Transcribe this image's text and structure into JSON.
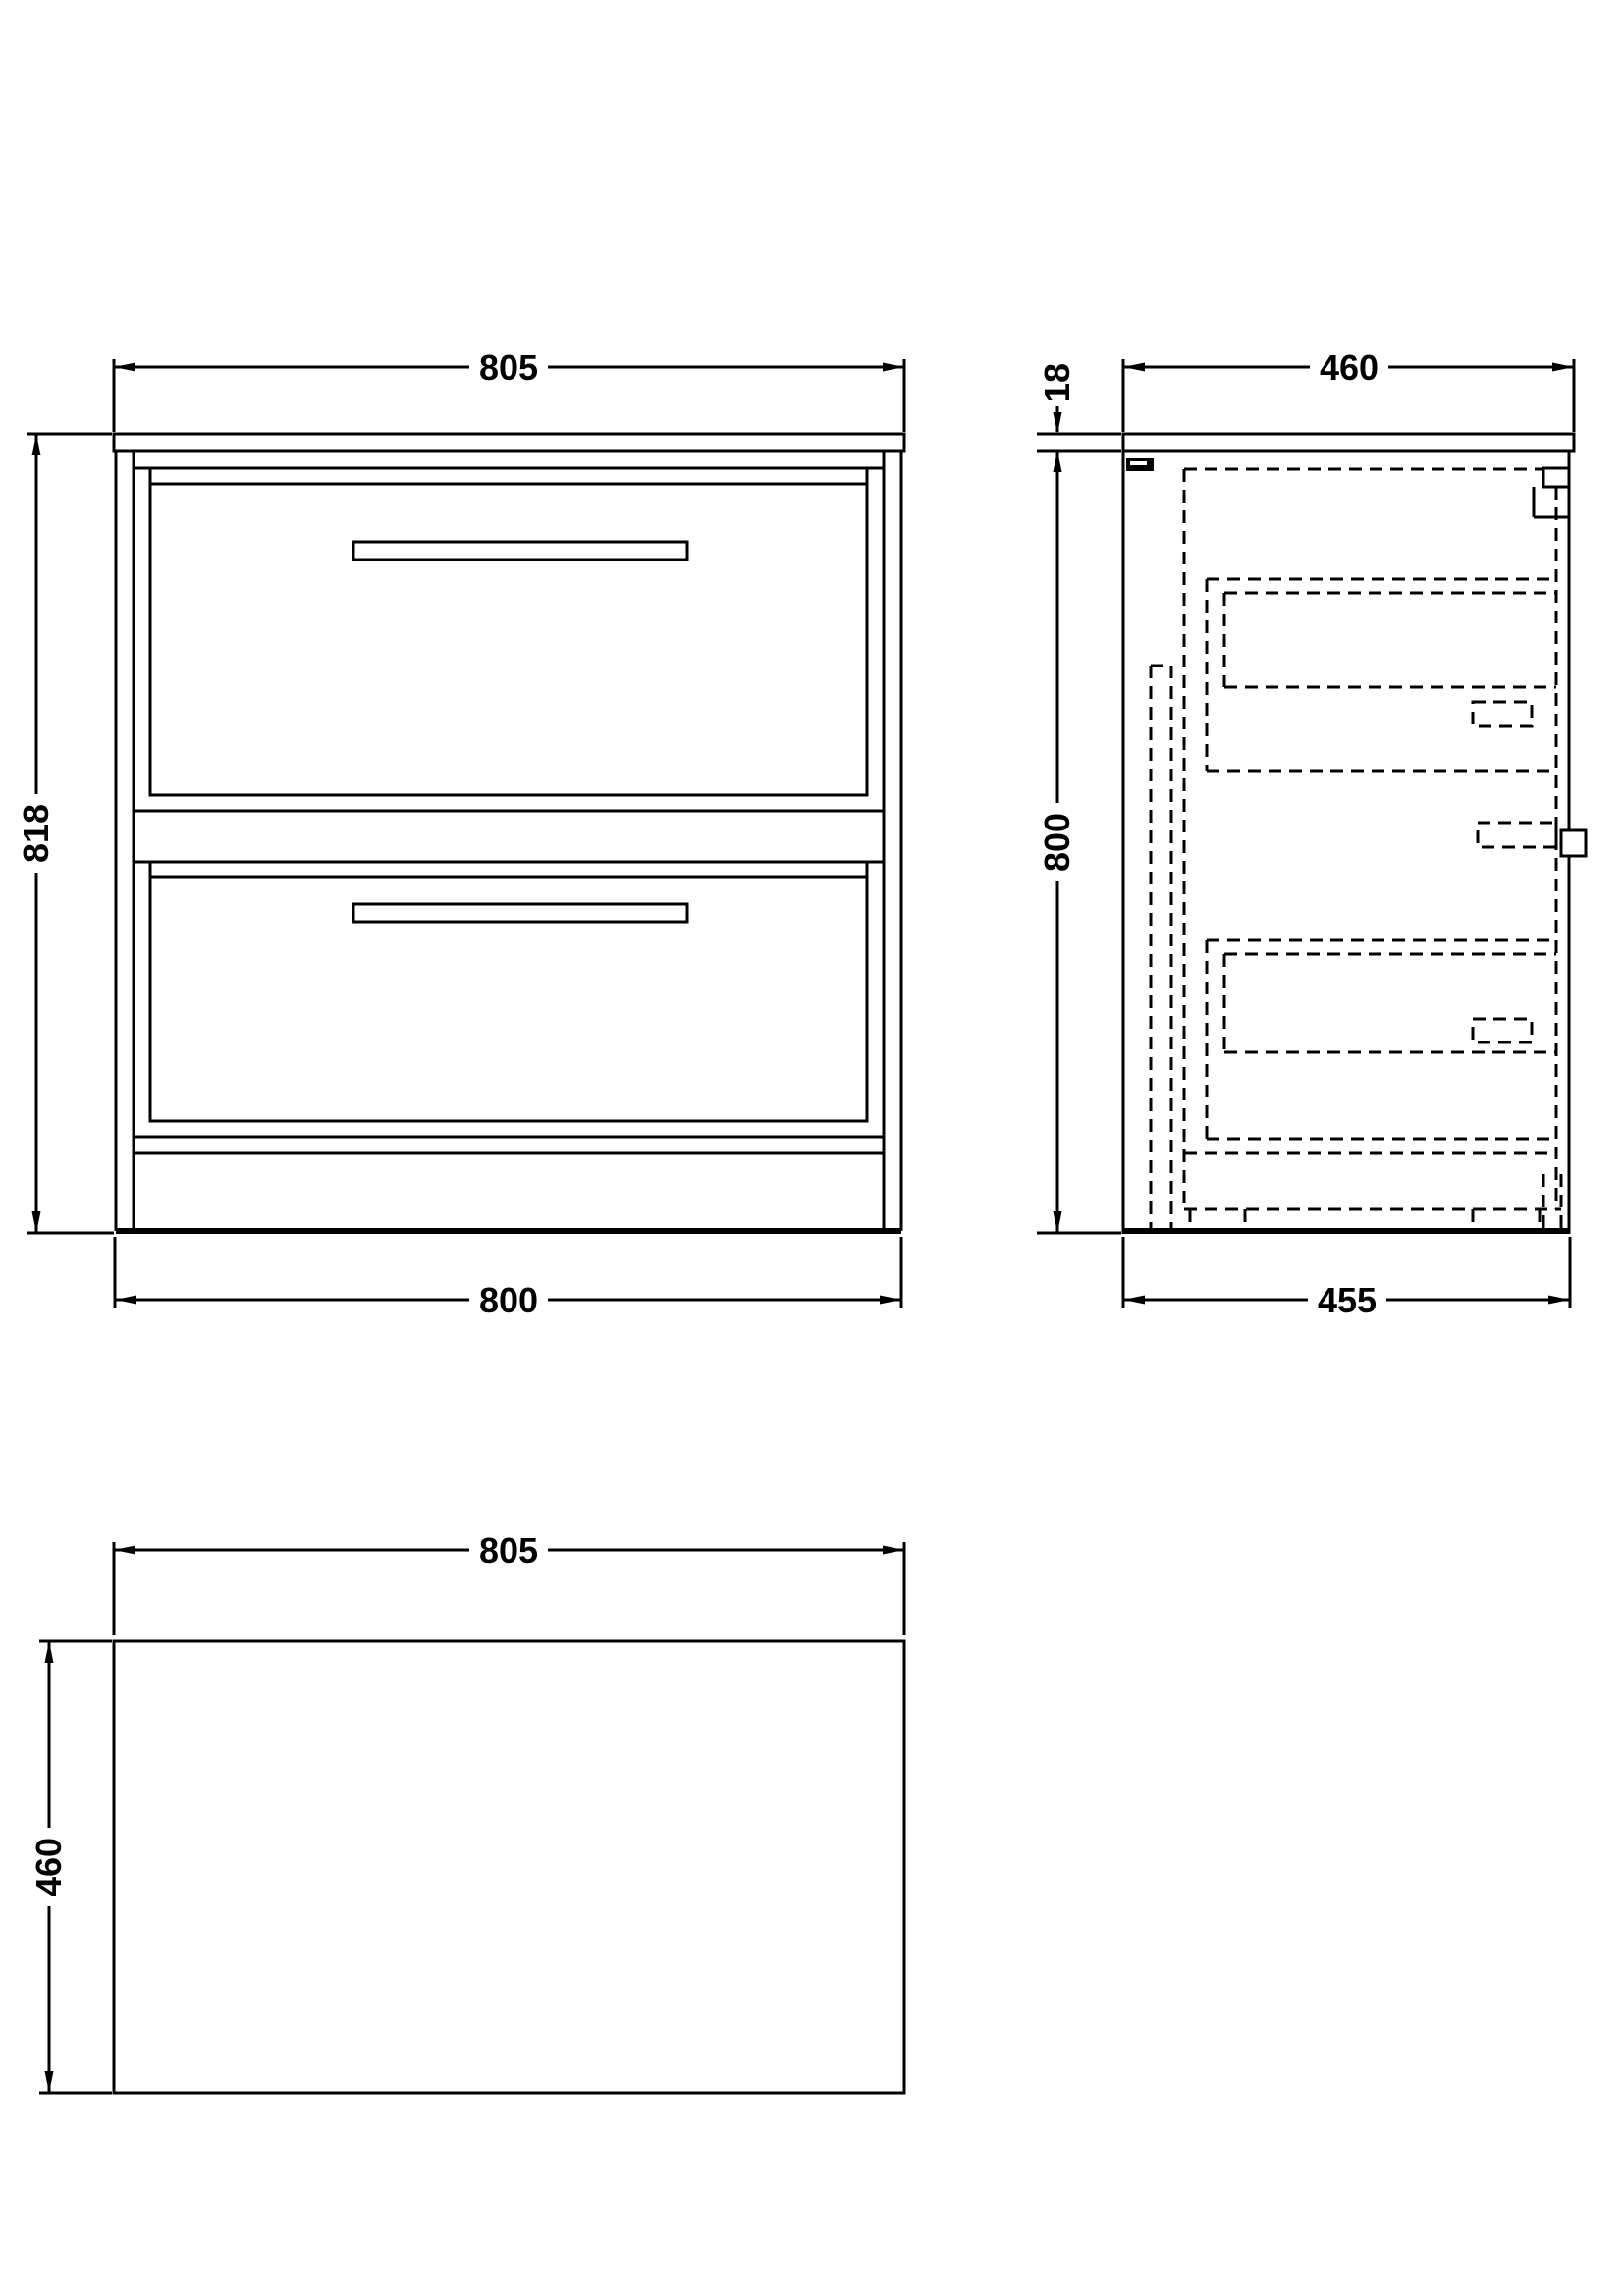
{
  "drawing": {
    "description": "vanity-unit-technical-dimension-drawing",
    "line_color": "#000000",
    "background_color": "#ffffff",
    "front": {
      "width_top": "805",
      "height_left": "818",
      "width_bottom": "800"
    },
    "side": {
      "depth_top": "460",
      "top_thickness": "18",
      "height_left": "800",
      "depth_bottom": "455"
    },
    "plan": {
      "width_top": "805",
      "depth_left": "460"
    }
  }
}
